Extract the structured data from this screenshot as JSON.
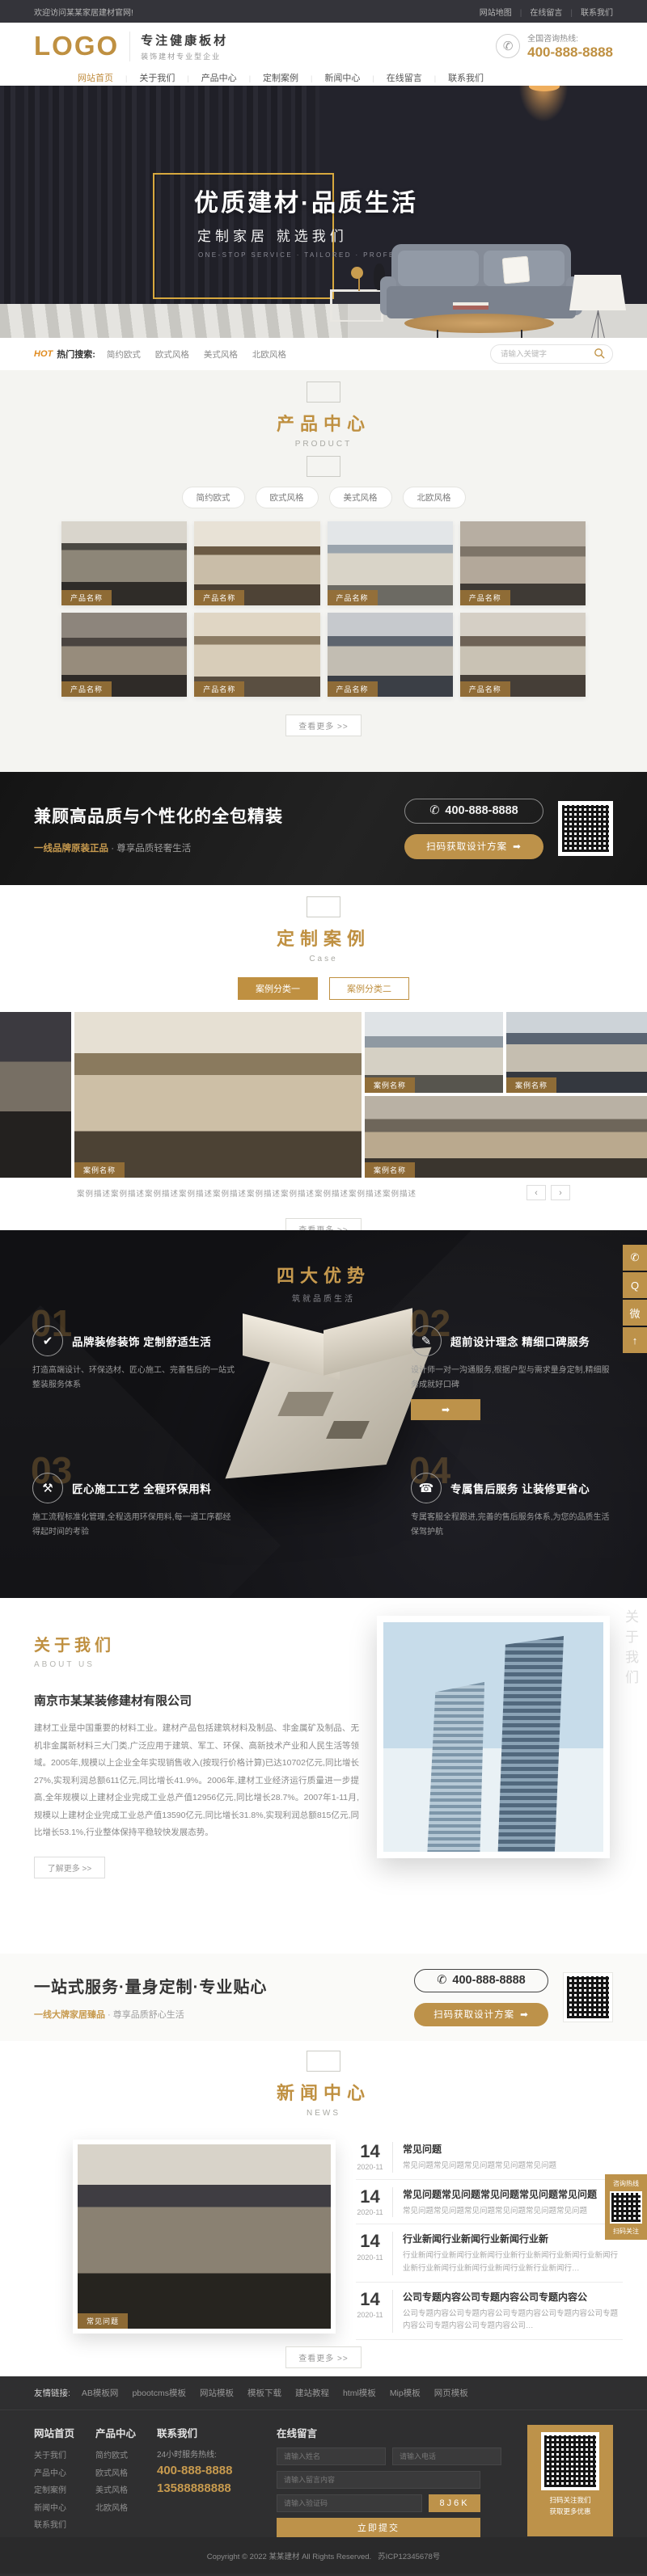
{
  "topbar": {
    "welcome": "欢迎访问某某家居建材官网!",
    "links": [
      "网站地图",
      "在线留言",
      "联系我们"
    ]
  },
  "header": {
    "logo": "LOGO",
    "slogan_main": "专注健康板材",
    "slogan_sub": "装饰建材专业型企业",
    "hotline_label": "全国咨询热线:",
    "hotline_number": "400-888-8888",
    "phone_icon": "✆"
  },
  "nav": {
    "items": [
      {
        "label": "网站首页"
      },
      {
        "label": "关于我们"
      },
      {
        "label": "产品中心"
      },
      {
        "label": "定制案例"
      },
      {
        "label": "新闻中心"
      },
      {
        "label": "在线留言"
      },
      {
        "label": "联系我们"
      }
    ]
  },
  "banner": {
    "title": "优质建材·品质生活",
    "subtitle": "定制家居 就选我们",
    "caption_en": "ONE-STOP SERVICE · TAILORED · PROFESSIONAL INTIMATE"
  },
  "search": {
    "hot": "HOT",
    "label": "热门搜索:",
    "keywords": [
      "简约欧式",
      "欧式风格",
      "美式风格",
      "北欧风格"
    ],
    "placeholder": "请输入关键字"
  },
  "products": {
    "title": "产品中心",
    "subtitle": "PRODUCT",
    "filters": [
      "简约欧式",
      "欧式风格",
      "美式风格",
      "北欧风格"
    ],
    "items": [
      {
        "name": "产品名称"
      },
      {
        "name": "产品名称"
      },
      {
        "name": "产品名称"
      },
      {
        "name": "产品名称"
      },
      {
        "name": "产品名称"
      },
      {
        "name": "产品名称"
      },
      {
        "name": "产品名称"
      },
      {
        "name": "产品名称"
      }
    ],
    "more": "查看更多 >>"
  },
  "cta1": {
    "title": "兼顾高品质与个性化的全包精装",
    "subtitle_em": "一线品牌原装正品",
    "subtitle_rest": " · 尊享品质轻奢生活",
    "phone_icon": "✆",
    "phone": "400-888-8888",
    "button": "扫码获取设计方案",
    "button_arrow": "➡"
  },
  "cases": {
    "title": "定制案例",
    "subtitle": "Case",
    "tabs": [
      "案例分类一",
      "案例分类二"
    ],
    "slides": [
      {
        "name": "案例名称"
      },
      {
        "name": "案例名称"
      },
      {
        "name": "案例名称"
      },
      {
        "name": "案例名称"
      }
    ],
    "caption": "案例描述案例描述案例描述案例描述案例描述案例描述案例描述案例描述案例描述案例描述",
    "prev": "‹",
    "next": "›",
    "more": "查看更多 >>"
  },
  "advantages": {
    "title": "四大优势",
    "subtitle": "筑就品质生活",
    "items": [
      {
        "num": "01",
        "icon": "✔",
        "title": "品牌装修装饰 定制舒适生活",
        "desc": "打造高端设计、环保选材、匠心施工、完善售后的一站式整装服务体系"
      },
      {
        "num": "02",
        "icon": "✎",
        "title": "超前设计理念 精细口碑服务",
        "desc": "设计师一对一沟通服务,根据户型与需求量身定制,精细服务成就好口碑",
        "tag_arrow": "➡"
      },
      {
        "num": "03",
        "icon": "⚒",
        "title": "匠心施工工艺 全程环保用料",
        "desc": "施工流程标准化管理,全程选用环保用料,每一道工序都经得起时间的考验"
      },
      {
        "num": "04",
        "icon": "☎",
        "title": "专属售后服务 让装修更省心",
        "desc": "专属客服全程跟进,完善的售后服务体系,为您的品质生活保驾护航"
      }
    ]
  },
  "about": {
    "title": "关于我们",
    "subtitle": "ABOUT US",
    "company": "南京市某某装修建材有限公司",
    "paragraph": "建材工业是中国重要的材料工业。建材产品包括建筑材料及制品、非金属矿及制品、无机非金属新材料三大门类,广泛应用于建筑、军工、环保、高新技术产业和人民生活等领域。2005年,规模以上企业全年实现销售收入(按现行价格计算)已达10702亿元,同比增长27%,实现利润总额611亿元,同比增长41.9%。2006年,建材工业经济运行质量进一步提高,全年规模以上建材企业完成工业总产值12956亿元,同比增长28.7%。2007年1-11月,规模以上建材企业完成工业总产值13590亿元,同比增长31.8%,实现利润总额815亿元,同比增长53.1%,行业整体保持平稳较快发展态势。",
    "more": "了解更多 >>",
    "side_label": "关于我们"
  },
  "cta2": {
    "title": "一站式服务·量身定制·专业贴心",
    "subtitle_em": "一线大牌家居臻品",
    "subtitle_rest": " · 尊享品质舒心生活",
    "phone_icon": "✆",
    "phone": "400-888-8888",
    "button": "扫码获取设计方案",
    "button_arrow": "➡"
  },
  "news": {
    "title": "新闻中心",
    "subtitle": "NEWS",
    "featured_label": "常见问题",
    "items": [
      {
        "day": "14",
        "date": "2020-11",
        "title": "常见问题",
        "desc": "常见问题常见问题常见问题常见问题常见问题"
      },
      {
        "day": "14",
        "date": "2020-11",
        "title": "常见问题常见问题常见问题常见问题常见问题",
        "desc": "常见问题常见问题常见问题常见问题常见问题常见问题"
      },
      {
        "day": "14",
        "date": "2020-11",
        "title": "行业新闻行业新闻行业新闻行业新",
        "desc": "行业新闻行业新闻行业新闻行业新行业新闻行业新闻行业新闻行业新行业新闻行业新闻行业新闻行业新行业新闻行…"
      },
      {
        "day": "14",
        "date": "2020-11",
        "title": "公司专题内容公司专题内容公司专题内容公",
        "desc": "公司专题内容公司专题内容公司专题内容公司专题内容公司专题内容公司专题内容公司专题内容公司…"
      }
    ],
    "more": "查看更多 >>"
  },
  "float_tools": {
    "items": [
      {
        "icon": "✆",
        "name": "phone"
      },
      {
        "icon": "Q",
        "name": "qq"
      },
      {
        "icon": "微",
        "name": "wechat"
      },
      {
        "icon": "↑",
        "name": "back-top"
      }
    ]
  },
  "float_qr": {
    "line1": "咨询热线",
    "line2": "扫码关注"
  },
  "footer": {
    "links_label": "友情链接:",
    "links": [
      "AB模板网",
      "pbootcms模板",
      "网站模板",
      "模板下载",
      "建站教程",
      "html模板",
      "Mip模板",
      "网页模板"
    ],
    "col1": {
      "title": "网站首页",
      "items": [
        "关于我们",
        "产品中心",
        "定制案例",
        "新闻中心",
        "联系我们"
      ]
    },
    "col2": {
      "title": "产品中心",
      "items": [
        "简约欧式",
        "欧式风格",
        "美式风格",
        "北欧风格"
      ]
    },
    "contact": {
      "title": "联系我们",
      "hotline_label": "24小时服务热线:",
      "phone1": "400-888-8888",
      "phone2": "13588888888"
    },
    "form": {
      "title": "在线留言",
      "name_ph": "请输入姓名",
      "tel_ph": "请输入电话",
      "msg_ph": "请输入留言内容",
      "captcha_ph": "请输入验证码",
      "captcha": "8J6K",
      "submit": "立即提交"
    },
    "qr_caption1": "扫码关注我们",
    "qr_caption2": "获取更多优惠",
    "copyright": "Copyright © 2022 某某建材 All Rights Reserved.",
    "icp": "苏ICP12345678号"
  }
}
